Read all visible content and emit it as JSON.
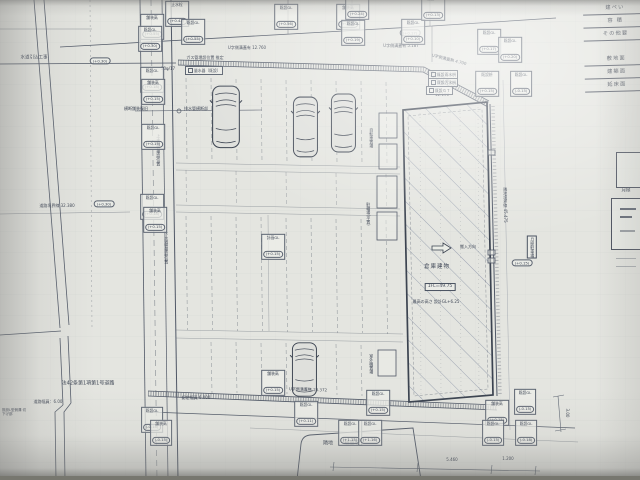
{
  "photo": {
    "paper": "#e4e5e0",
    "line_color": "#4f5766",
    "hatch_color": "#97a0b0"
  },
  "area_table": {
    "rows": [
      "建ぺい",
      "容 積",
      "その他要",
      "敷地面",
      "建築面",
      "延床面"
    ]
  },
  "side_note": "月極",
  "building": {
    "name": "倉庫建物",
    "floor_level": "1FL=49.75",
    "height_note": "最高の高さ 設計GL+6.25",
    "arrow_label": "搬入方向",
    "top_dim": "12.190"
  },
  "road": {
    "name": "法42条第1項第1号道路",
    "width": "道路幅員：6.00",
    "certified_width": "認定幅員 6.000",
    "boundary_length": "道路境界線 32.380",
    "water_intake": "水道引込工事",
    "crossing": "排水管横断部",
    "crossing_repair": "横断舗装復旧",
    "pipe_upper": "上水道管埋設位置",
    "pipe_lower": "下水道管埋設位置"
  },
  "gutter": {
    "top": "U字側溝蓋有 12.760",
    "gas": "ガス管埋設位置 推定",
    "water_meter": "量水器〔既設〕",
    "meter_size": "50φ/17",
    "top_right_a": "U字側溝蓋有 5.187",
    "top_right_b": "U字側溝蓋無 4.700",
    "bottom": "U字側溝蓋無 23.372"
  },
  "east": {
    "boundary": "隣地境界線 45.475",
    "parking": "月極駐車場"
  },
  "site_items": {
    "bike1": "自転車置場",
    "bike2": "駐輪場(平置)",
    "equipment": "室外機置場",
    "neighbor_a": "隣地",
    "neighbor_b": "駐車場",
    "l_gutter": "既設L型側溝 切下げ部"
  },
  "dims": {
    "a": "5.460",
    "b": "1.200",
    "c": "3.00"
  },
  "utility_boxes": [
    "既設雨水枡",
    "既設汚水枡",
    "既設ＧＴ"
  ],
  "ovals": [
    "(+0.30)",
    "(+0.30)",
    "(+0.15)",
    "(+0.17)"
  ],
  "spot_labels": [
    {
      "t": "既設GL",
      "v": "(+0.56)"
    },
    {
      "t": "舗装高",
      "v": "(+0.55)"
    },
    {
      "t": "既設GL",
      "v": "(+0.19)"
    },
    {
      "t": "既設GL",
      "v": "(+0.10)"
    },
    {
      "t": "既設GL",
      "v": "(+0.17)"
    },
    {
      "t": "既設GL",
      "v": "(+0.20)"
    },
    {
      "t": "既設枡",
      "v": "(+0.15)"
    },
    {
      "t": "既設GL",
      "v": "(-0.15)"
    },
    {
      "t": "止水栓",
      "v": "(+0.42)"
    },
    {
      "t": "既設GL",
      "v": "(+0.55)"
    },
    {
      "t": "舗装高",
      "v": "(+0.55)"
    },
    {
      "t": "既設GL",
      "v": "(+0.30)"
    },
    {
      "t": "既設GL",
      "v": "(+0.18)"
    },
    {
      "t": "舗装高",
      "v": "(+0.15)"
    },
    {
      "t": "既設GL",
      "v": "(+0.15)"
    },
    {
      "t": "計画GL",
      "v": "(+0.15)"
    },
    {
      "t": "既設GL",
      "v": "(+0.18)"
    },
    {
      "t": "舗装高",
      "v": "(+0.15)"
    },
    {
      "t": "舗装高",
      "v": "(+0.15)"
    },
    {
      "t": "既設GL",
      "v": "(+0.11)"
    },
    {
      "t": "既設GL",
      "v": "(+0.15)"
    },
    {
      "t": "既設GL",
      "v": "(+1.15)"
    },
    {
      "t": "既設GL",
      "v": "(+1.16)"
    },
    {
      "t": "既設GL",
      "v": "(-0.15)"
    },
    {
      "t": "舗装高",
      "v": "(+0.15)"
    },
    {
      "t": "既設GL",
      "v": "(-0.15)"
    },
    {
      "t": "既設GL",
      "v": "(-0.18)"
    },
    {
      "t": "既設GL",
      "v": "(-0.18)"
    },
    {
      "t": "舗装高",
      "v": "(-0.15)"
    },
    {
      "t": "既設GL",
      "v": "(+0.24)"
    },
    {
      "t": "既設GL",
      "v": "(+0.13)"
    }
  ]
}
